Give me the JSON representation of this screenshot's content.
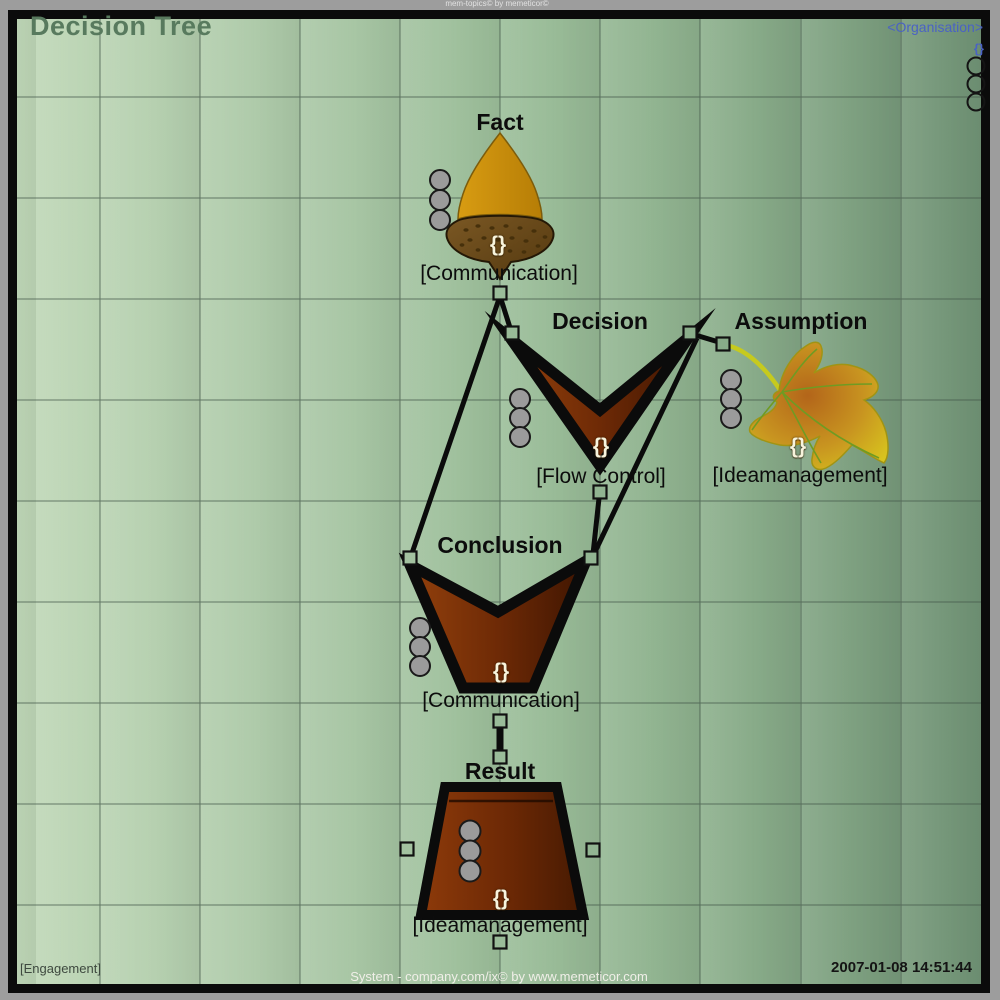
{
  "window": {
    "watermark": "mem-topics© by memeticor©",
    "title": "Decision Tree"
  },
  "organisation": {
    "label": "<Organisation>",
    "braces": "{}"
  },
  "nodes": [
    {
      "id": "fact",
      "label": "Fact",
      "tag": "[Communication]",
      "braces": "{}",
      "icon": "acorn-icon"
    },
    {
      "id": "decision",
      "label": "Decision",
      "tag": "[Flow Control]",
      "braces": "{}",
      "icon": "chevron-icon"
    },
    {
      "id": "assumption",
      "label": "Assumption",
      "tag": "[Ideamanagement]",
      "braces": "{}",
      "icon": "maple-leaf-icon"
    },
    {
      "id": "conclusion",
      "label": "Conclusion",
      "tag": "[Communication]",
      "braces": "{}",
      "icon": "funnel-icon"
    },
    {
      "id": "result",
      "label": "Result",
      "tag": "[Ideamanagement]",
      "braces": "{}",
      "icon": "pot-icon"
    }
  ],
  "footer": {
    "engagement": "[Engagement]",
    "credit": "System - company.com/ix© by www.memeticor.com",
    "timestamp": "2007-01-08 14:51:44"
  },
  "colors": {
    "canvas_gradient_left": "#c0d8b8",
    "canvas_gradient_right": "#6f9174",
    "node_brown": "#7a2e06",
    "acorn_gold": "#cd8d0d",
    "leaf_yellow": "#d6c320",
    "link_blue": "#4a62c4",
    "grid_line": "#44584a"
  }
}
